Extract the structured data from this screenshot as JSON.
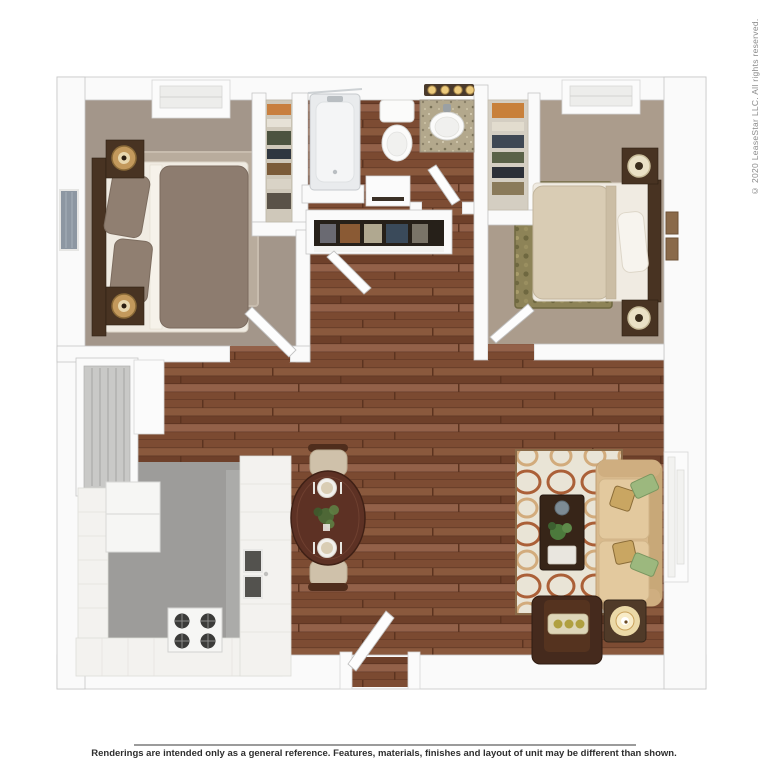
{
  "texts": {
    "disclaimer": "Renderings are intended only as a general reference. Features, materials, finishes and layout of unit may be different than shown.",
    "copyright": "© 2020 LeaseStar LLC. All rights reserved."
  },
  "palette": {
    "wall": "#fafafa",
    "wallLine": "#c6c6c6",
    "wood1": "#7d4c33",
    "wood2": "#8a593d",
    "wood3": "#6e402a",
    "wood4": "#936149",
    "wood5": "#7b4a31",
    "woodSeam": "#5c3420",
    "carpetLeft": "#a3968a",
    "carpetRight": "#ab9c8c",
    "rugLeft": "#b9ac9d",
    "rugRightBase": "#8d8357",
    "rugLivingBase": "#e9e4d6",
    "rugLivingRust": "#ab6038",
    "rugLivingTan": "#d2ab7c",
    "kitchenFloor": "#9d9c9a",
    "counter": "#f3f2ef",
    "fixtureWhite": "#fbfbfb",
    "applianceWhite": "#f6f6f4",
    "granite": "#b3a88c",
    "bedspreadLeft": "#8d7c6f",
    "bedspreadRight": "#d9ccb4",
    "sheets": "#f0ebe2",
    "headboard": "#4c3829",
    "darkWood": "#483322",
    "lampBrass": "#c3995c",
    "lampCream": "#eae1c6",
    "sofaTan": "#d8b98c",
    "cushionTan": "#e3c99e",
    "armchairBrown": "#452a1d",
    "tableBrown": "#5d3124",
    "coffeeBrown": "#372518",
    "pillowGreen": "#9cb87e",
    "pillowLeopard": "#c9a662",
    "glow": "#f3e2ae",
    "disclaimerColor": "#2e2e2e",
    "copyrightColor": "#8a8a8a",
    "ruleColor": "#9b9b9b"
  },
  "floorplan": {
    "description": "3D top-down rendering of a two-bedroom, one-bath apartment",
    "rooms": [
      {
        "name": "bedroom-left",
        "floor": "taupe carpet"
      },
      {
        "name": "bedroom-right",
        "floor": "tan carpet"
      },
      {
        "name": "bathroom",
        "floor": "wood"
      },
      {
        "name": "hallway",
        "floor": "wood"
      },
      {
        "name": "living-dining",
        "floor": "wood"
      },
      {
        "name": "kitchen",
        "floor": "gray vinyl"
      },
      {
        "name": "closet-left-bedroom"
      },
      {
        "name": "closet-right-bedroom"
      },
      {
        "name": "linen-closet"
      },
      {
        "name": "utility-closet"
      }
    ],
    "furniture": [
      "bed with nightstands and lamps (left bedroom)",
      "bed with nightstands and lamps (right bedroom)",
      "bathtub",
      "toilet",
      "vanity sink with lights",
      "range stove",
      "refrigerator",
      "kitchen counters with sink",
      "oval dining table with two chairs and place settings",
      "tan sofa with throw pillows",
      "coffee table",
      "accent armchair",
      "side table with lamp",
      "patterned area rugs"
    ]
  }
}
